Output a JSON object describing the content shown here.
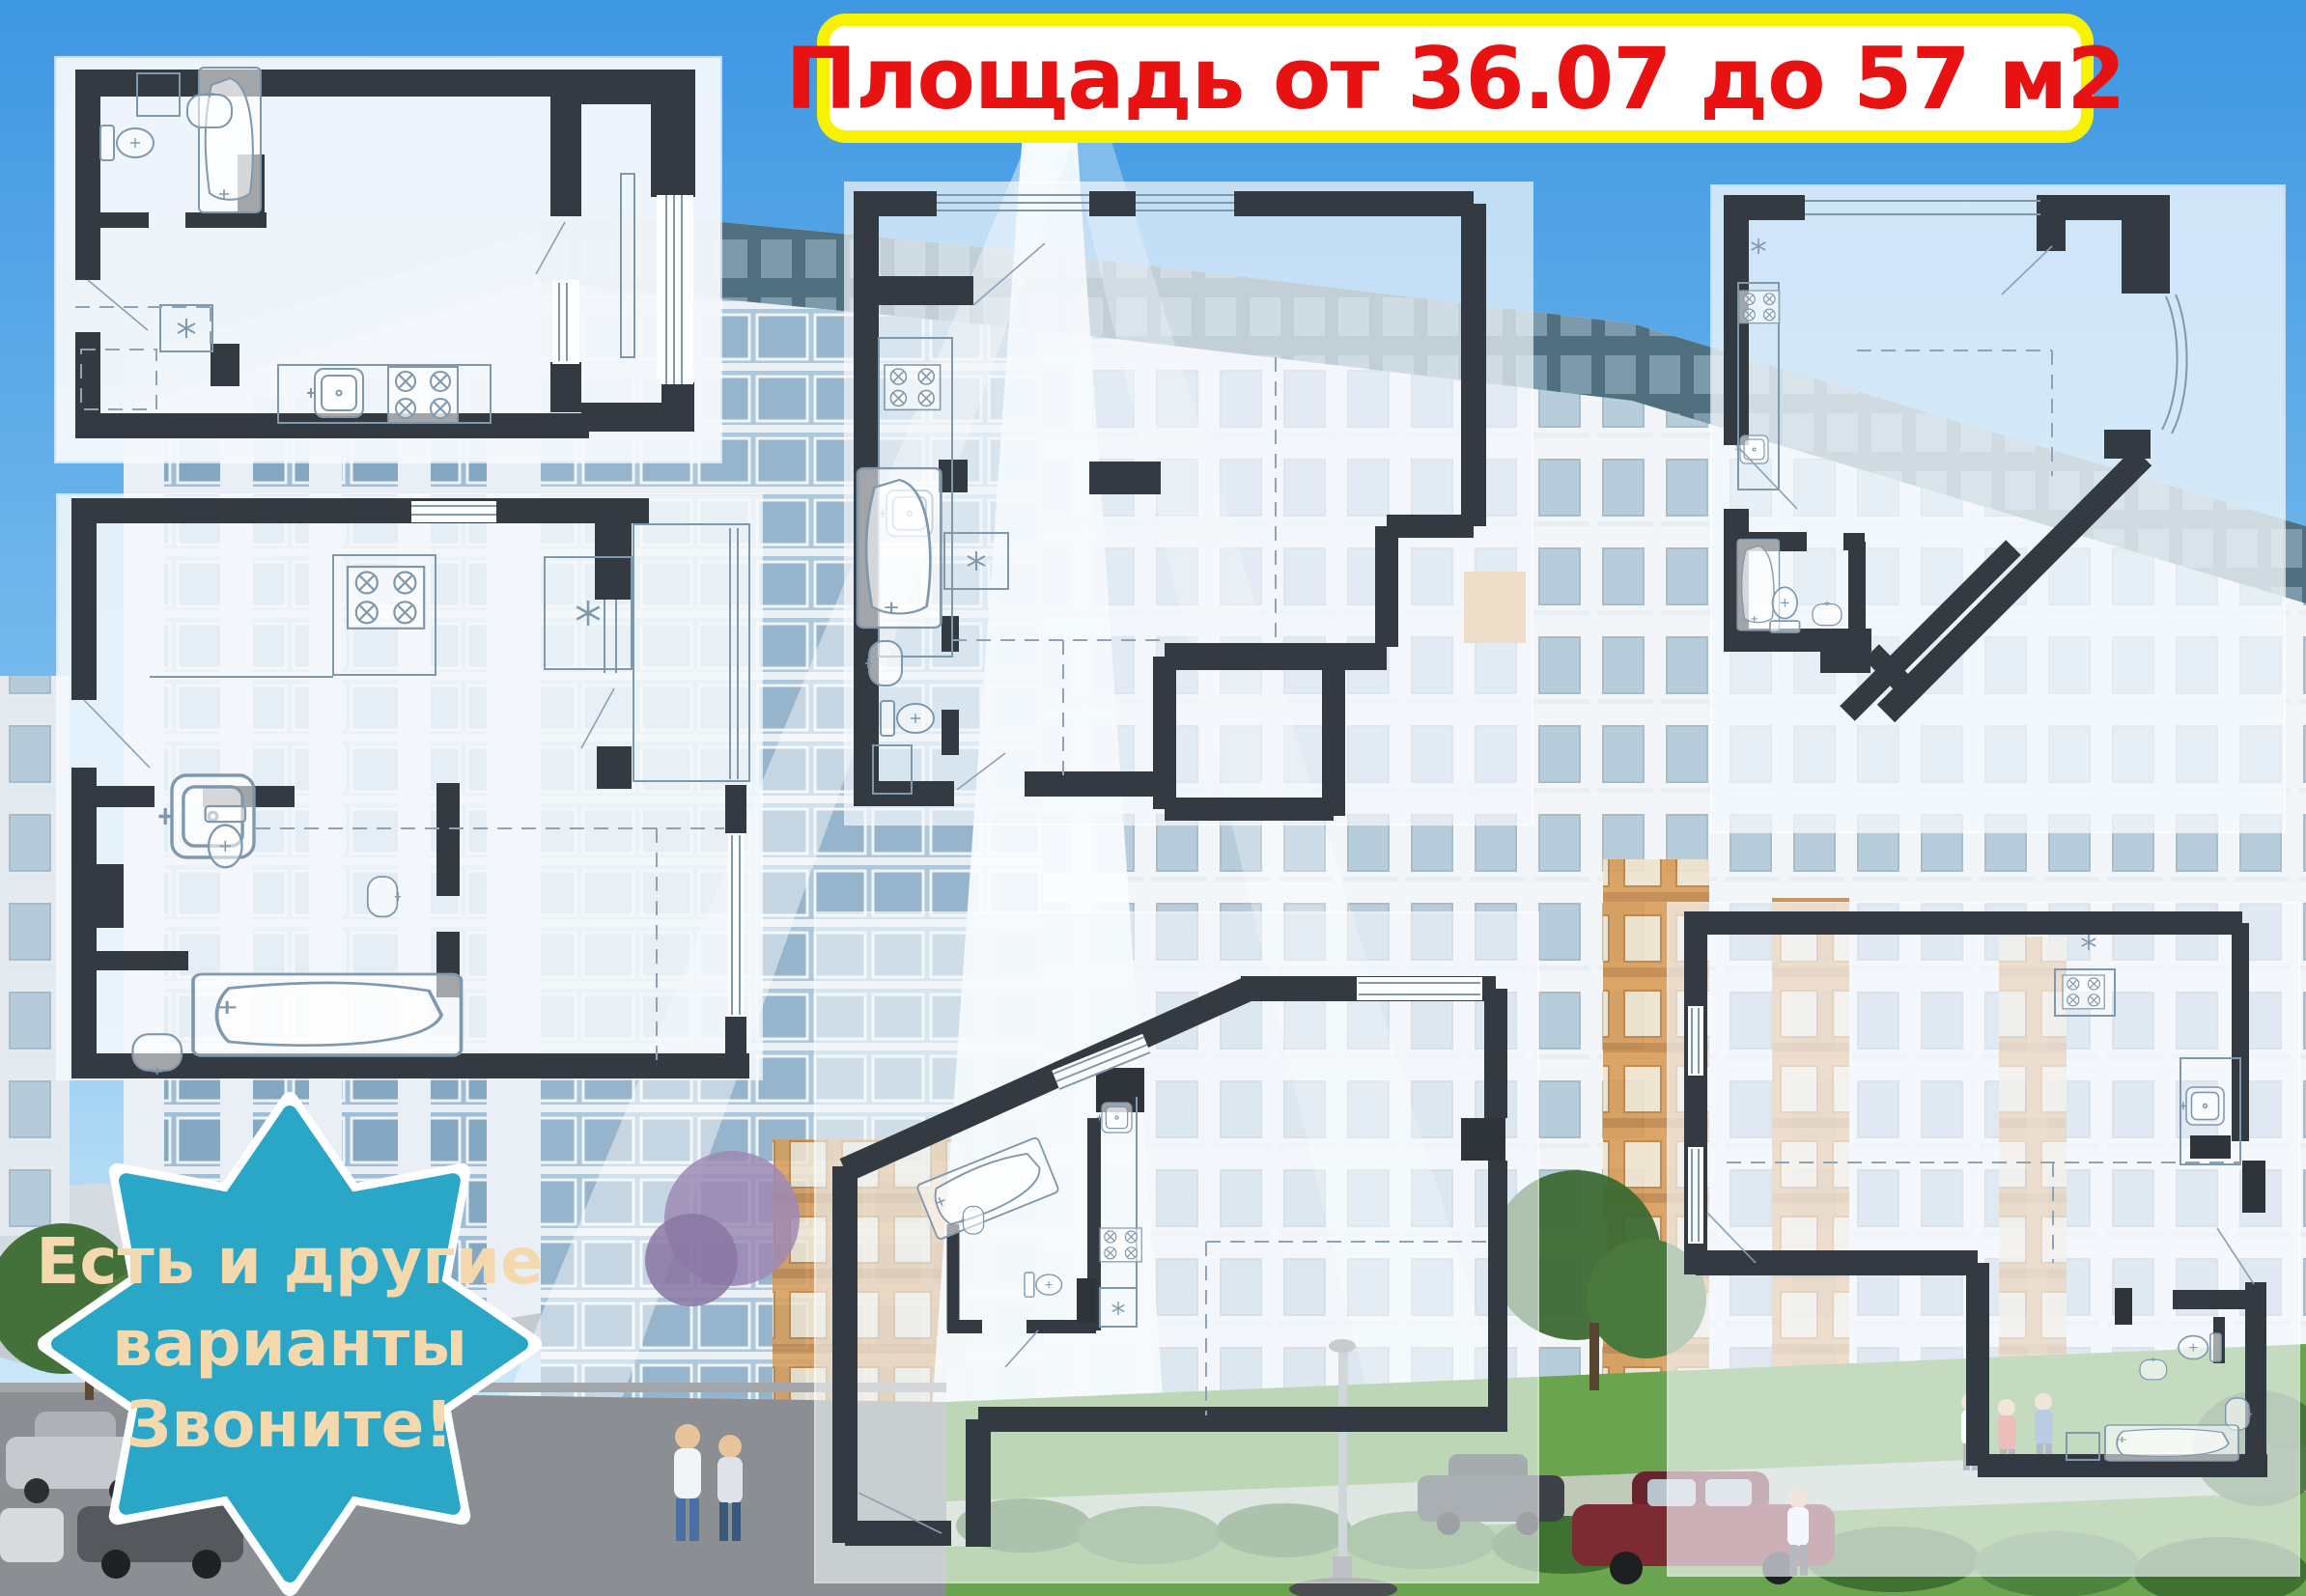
{
  "title": {
    "text": "Площадь от 36.07 до 57 м2",
    "text_color": "#e81212",
    "bg_color": "#ffffff",
    "border_color": "#f6f200"
  },
  "badge": {
    "line1": "Есть и другие",
    "line2": "варианты",
    "line3": "Звоните!",
    "bg_color": "#2aa6c6",
    "text_color": "#f5d9ae",
    "border_color": "#ffffff"
  },
  "floorplans": [
    {
      "id": "plan-1",
      "position": "top-left"
    },
    {
      "id": "plan-2",
      "position": "middle-left"
    },
    {
      "id": "plan-3",
      "position": "top-center"
    },
    {
      "id": "plan-4",
      "position": "top-right"
    },
    {
      "id": "plan-5",
      "position": "bottom-center"
    },
    {
      "id": "plan-6",
      "position": "bottom-right"
    }
  ],
  "background": {
    "sky_top": "#3e97e2",
    "sky_bottom": "#bfe0f5",
    "building_white": "#f2f6f9",
    "building_band": "#54727f",
    "glass_blue": "#8fb2cb",
    "accent_orange": "#d89c58",
    "lawn_green": "#6aa44e",
    "road_gray": "#8b8e92",
    "plan_wall": "#333a41",
    "panel_bg": "#f4f8fc"
  }
}
